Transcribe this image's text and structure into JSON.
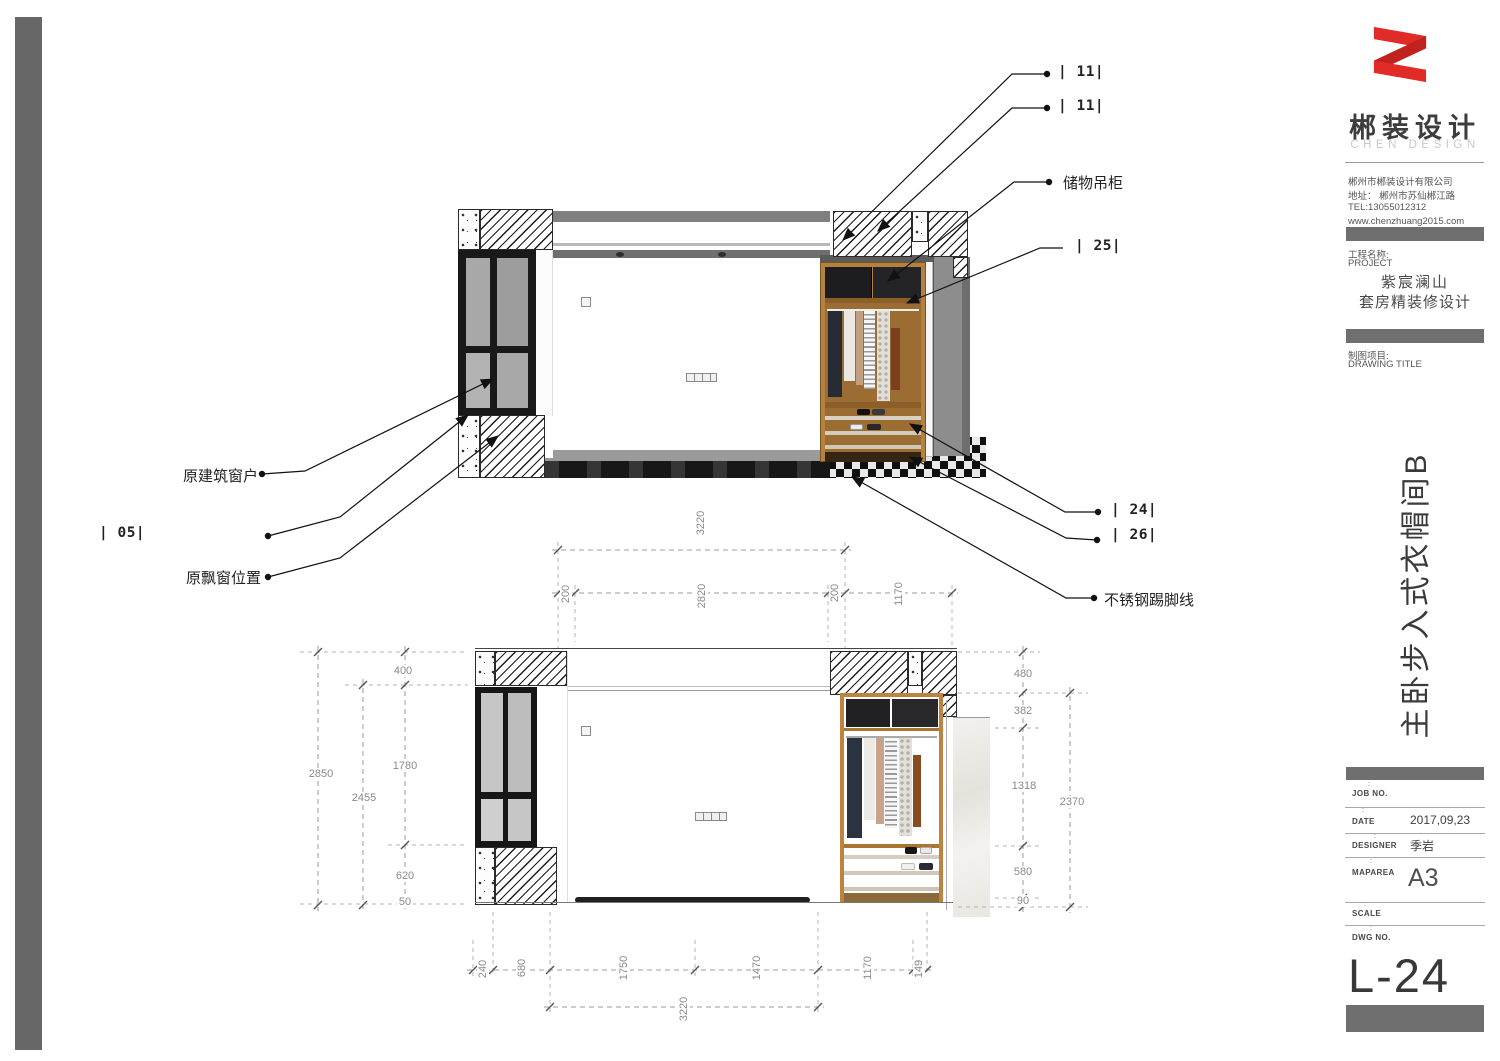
{
  "brand": {
    "logo": "red-folded-z-ribbon",
    "name_cn": "郴装设计",
    "name_en": "CHEN DESIGN",
    "company": "郴州市郴装设计有限公司",
    "address": "地址： 郴州市苏仙郴江路",
    "tel": "TEL:13055012312",
    "web": "www.chenzhuang2015.com"
  },
  "project": {
    "label_cn": "工程名称:",
    "label_en": "PROJECT",
    "name1": "紫宸澜山",
    "name2": "套房精装修设计"
  },
  "drawing_title": {
    "label_cn": "制图项目:",
    "label_en": "DRAWING TITLE",
    "vertical": "主卧步入式衣帽间B"
  },
  "fields": [
    {
      "label": "JOB NO.",
      "tick": ":",
      "value": ""
    },
    {
      "label": "DATE",
      "tick": ":",
      "value": "2017,09,23"
    },
    {
      "label": "DESIGNER",
      "tick": ":",
      "value": "季岩"
    },
    {
      "label": "MAPAREA",
      "tick": ":",
      "value": "A3"
    },
    {
      "label": "SCALE",
      "tick": ":",
      "value": ""
    },
    {
      "label": "DWG NO.",
      "tick": ":",
      "value": ""
    }
  ],
  "sheet_no": "L-24",
  "callouts": {
    "c11a": "| 11|",
    "c11b": "| 11|",
    "storage_cabinet": "储物吊柜",
    "c25": "| 25|",
    "c24": "| 24|",
    "c26": "| 26|",
    "skirting": "不锈钢踢脚线",
    "original_window": "原建筑窗户",
    "c05": "| 05|",
    "bay_window": "原飘窗位置"
  },
  "dims": {
    "top_3220": "3220",
    "top_200l": "200",
    "top_2820": "2820",
    "top_200r": "200",
    "top_1170": "1170",
    "left_400": "400",
    "left_2850": "2850",
    "left_1780": "1780",
    "left_2455": "2455",
    "left_620": "620",
    "left_50": "50",
    "right_480": "480",
    "right_382": "382",
    "right_1318": "1318",
    "right_2370": "2370",
    "right_580": "580",
    "right_90": "90",
    "bot_240": "240",
    "bot_680": "680",
    "bot_1750": "1750",
    "bot_1470": "1470",
    "bot_1170": "1170",
    "bot_149": "149",
    "bot_3220": "3220"
  }
}
